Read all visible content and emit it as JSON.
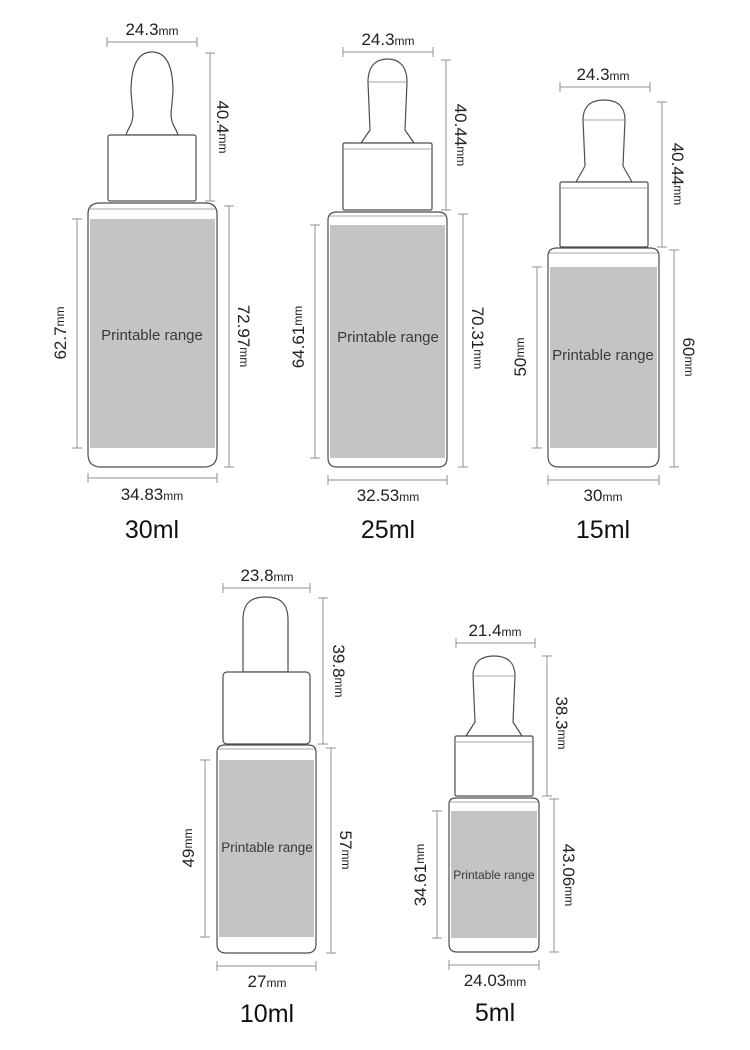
{
  "colors": {
    "printable_fill": "#c4c4c4",
    "outline": "#4d4d4d",
    "dimension_line": "#909090",
    "text": "#222222"
  },
  "bottles": [
    {
      "volume_label": "30ml",
      "printable_label": "Printable range",
      "top_width_value": "24.3",
      "top_width_unit": "mm",
      "dropper_height_value": "40.4",
      "dropper_height_unit": "mm",
      "printable_height_value": "62.7",
      "printable_height_unit": "mm",
      "body_height_value": "72.97",
      "body_height_unit": "mm",
      "bottom_width_value": "34.83",
      "bottom_width_unit": "mm"
    },
    {
      "volume_label": "25ml",
      "printable_label": "Printable range",
      "top_width_value": "24.3",
      "top_width_unit": "mm",
      "dropper_height_value": "40.44",
      "dropper_height_unit": "mm",
      "printable_height_value": "64.61",
      "printable_height_unit": "mm",
      "body_height_value": "70.31",
      "body_height_unit": "mm",
      "bottom_width_value": "32.53",
      "bottom_width_unit": "mm"
    },
    {
      "volume_label": "15ml",
      "printable_label": "Printable range",
      "top_width_value": "24.3",
      "top_width_unit": "mm",
      "dropper_height_value": "40.44",
      "dropper_height_unit": "mm",
      "printable_height_value": "50",
      "printable_height_unit": "mm",
      "body_height_value": "60",
      "body_height_unit": "mm",
      "bottom_width_value": "30",
      "bottom_width_unit": "mm"
    },
    {
      "volume_label": "10ml",
      "printable_label": "Printable range",
      "top_width_value": "23.8",
      "top_width_unit": "mm",
      "dropper_height_value": "39.8",
      "dropper_height_unit": "mm",
      "printable_height_value": "49",
      "printable_height_unit": "mm",
      "body_height_value": "57",
      "body_height_unit": "mm",
      "bottom_width_value": "27",
      "bottom_width_unit": "mm"
    },
    {
      "volume_label": "5ml",
      "printable_label": "Printable range",
      "top_width_value": "21.4",
      "top_width_unit": "mm",
      "dropper_height_value": "38.3",
      "dropper_height_unit": "mm",
      "printable_height_value": "34.61",
      "printable_height_unit": "mm",
      "body_height_value": "43.06",
      "body_height_unit": "mm",
      "bottom_width_value": "24.03",
      "bottom_width_unit": "mm"
    }
  ]
}
